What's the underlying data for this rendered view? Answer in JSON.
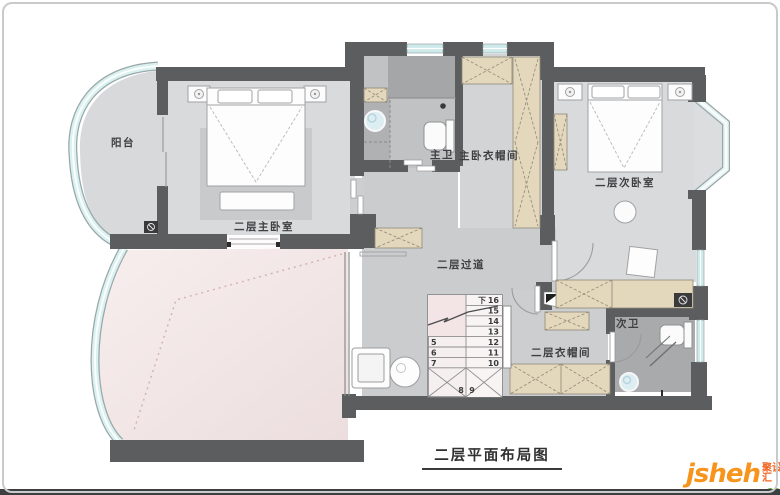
{
  "rooms": {
    "balcony": {
      "label": "阳台"
    },
    "master_bedroom": {
      "label": "二层主卧室"
    },
    "master_bath": {
      "label": "主卫"
    },
    "master_closet": {
      "label": "主卧衣帽间"
    },
    "second_bedroom": {
      "label": "二层次卧室"
    },
    "corridor": {
      "label": "二层过道"
    },
    "upper_closet": {
      "label": "二层衣帽间"
    },
    "second_bath": {
      "label": "次卫"
    }
  },
  "stairs": {
    "down_label": "下",
    "right_column": [
      "16",
      "15",
      "14",
      "13",
      "12",
      "11",
      "10"
    ],
    "left_column": [
      "5",
      "6",
      "7"
    ],
    "bottom_row": [
      "8",
      "9"
    ]
  },
  "caption": {
    "text": "二层平面布局图"
  },
  "logo": {
    "brand": "jsheh",
    "suffix": ".com",
    "badge": "聚设汇"
  },
  "colors": {
    "wall": "#5c5d5f",
    "bedroom_floor": "#d9dadc",
    "corridor_floor": "#cbccce",
    "bath_floor": "#b9babc",
    "void_pink": "#f3e6e6",
    "glass": "#d6efef",
    "wardrobe_tan": "#e3d7bc",
    "logo_orange": "#f7941e",
    "logo_green": "#76b043"
  }
}
